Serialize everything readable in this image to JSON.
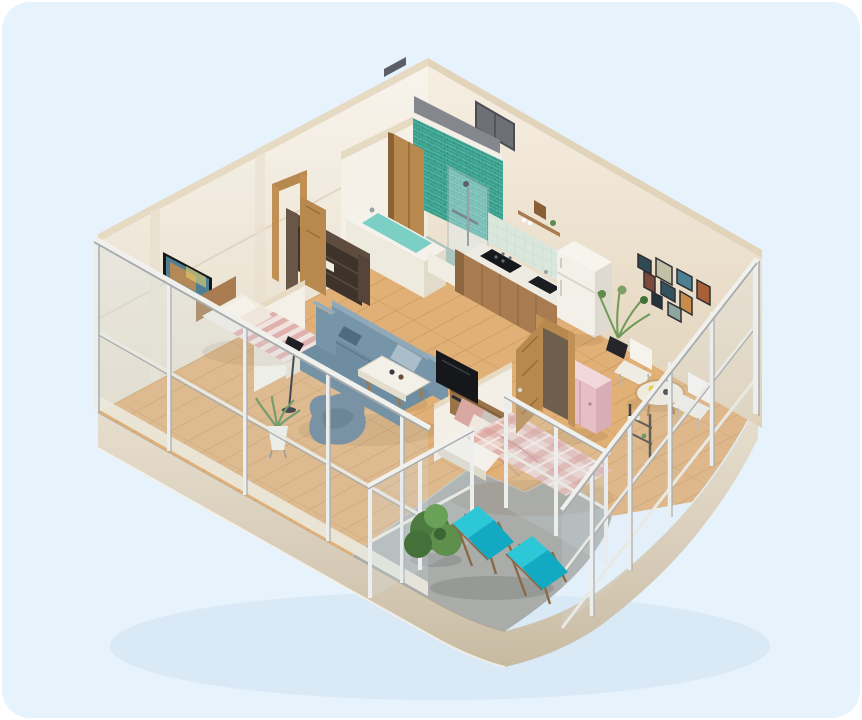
{
  "scene": {
    "kind": "isometric-3d-apartment-floor-plan-render",
    "description": "Cutaway 3D render of a one-bedroom apartment with glass facade walls, teal tiled bathroom, kitchen, living room, two sleeping areas and a curved corner terrace with lounge chairs",
    "rooms": [
      "bathroom",
      "kitchen",
      "hallway",
      "bedroom-single",
      "living-room",
      "bedroom-double",
      "dining-nook",
      "terrace"
    ],
    "items": [
      "bathtub",
      "shower-glass",
      "teal-tile-wall",
      "kitchen-counter",
      "cooktop",
      "sink",
      "fridge",
      "wall-shelf",
      "wardrobe",
      "interior-door",
      "entrance-door",
      "wall-tv",
      "single-bed",
      "sofa",
      "bean-bag",
      "coffee-table",
      "floor-lamp",
      "potted-plant",
      "tv",
      "double-bed",
      "pink-dresser",
      "dining-table",
      "dining-chairs",
      "gallery-picture-frames",
      "bathroom-window",
      "glass-railing",
      "lounge-chair",
      "lounge-chair",
      "terrace-shrub"
    ]
  },
  "palette": {
    "page": "#ffffff",
    "background": "#e6f2fc",
    "wall_left": "#f5eee2",
    "wall_right": "#f2e7d5",
    "wall_top": "#e7dac3",
    "wall_inner_dark": "#84878e",
    "slab_side": "#ddd1bb",
    "floor_wood": "#e0b077",
    "floor_terrace": "#a9aca9",
    "bath_floor": "#aac6bd",
    "tile_teal": "#3ba08e",
    "water_teal": "#7ccfc4",
    "white_fixture": "#f5f2ec",
    "mint_backsplash": "#d9e7dc",
    "counter_white": "#eeebe2",
    "appliance_black": "#17181c",
    "fridge_white": "#f3f0ea",
    "wood_furniture": "#a87c50",
    "wood_dark": "#5e4c3e",
    "door_wood": "#b8894f",
    "sofa_blue": "#7695a8",
    "sofa_blue_dark": "#5f7e93",
    "cushion_light": "#a9bec9",
    "bed_plaid_pink": "#ecd2cc",
    "bed_stripe_pink": "#f0e2de",
    "dresser_pink": "#e5bfc5",
    "dresser_pink_top": "#f2d8da",
    "bench_white": "#f4f1ea",
    "lounger_cyan": "#2cc8d8",
    "lounger_teal": "#12a9c2",
    "lounger_frame": "#8a6a46",
    "plant_green": "#5e8b4e",
    "plant_green_dark": "#44703a",
    "glass_frame": "#f0f0ec",
    "glass_shadow": "#a7abad",
    "metal_silver": "#9aa0a6",
    "tv_black": "#16171b",
    "screen_art_orange": "#c78b4c",
    "screen_art_blue": "#4e7f93"
  }
}
